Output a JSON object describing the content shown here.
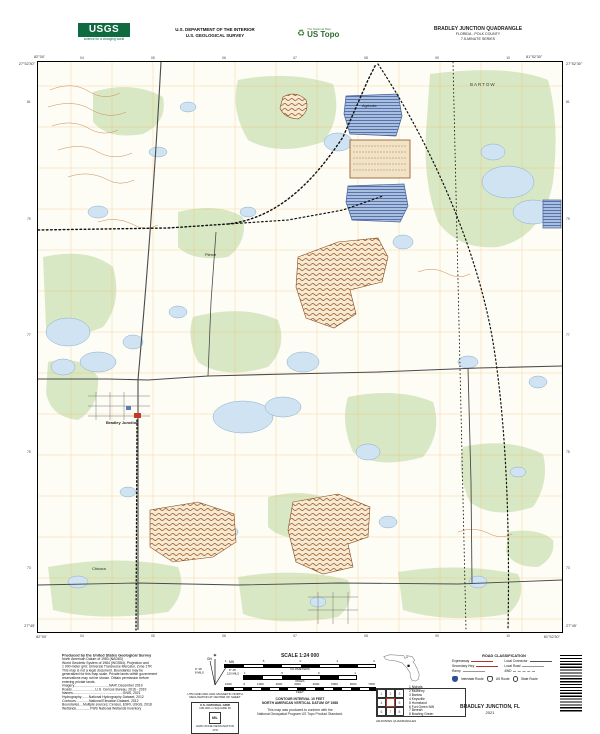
{
  "header": {
    "usgs_logo": "USGS",
    "usgs_tagline": "science for a changing world",
    "dept_line1": "U.S. DEPARTMENT OF THE INTERIOR",
    "dept_line2": "U.S. GEOLOGICAL SURVEY",
    "ustopo_overline": "The National Map",
    "ustopo_brand": "US Topo",
    "quad_title": "BRADLEY JUNCTION QUADRANGLE",
    "quad_subtitle1": "FLORIDA - POLK COUNTY",
    "quad_subtitle2": "7.5-MINUTE SERIES"
  },
  "map": {
    "corner_top_left_lat": "27°52'30\"",
    "corner_top_left_lon": "82°00'",
    "corner_top_right_lat": "27°52'30\"",
    "corner_top_right_lon": "81°52'30\"",
    "corner_bottom_left_lat": "27°45'",
    "corner_bottom_left_lon": "82°00'",
    "corner_bottom_right_lat": "27°45'",
    "corner_bottom_right_lon": "81°52'30\"",
    "ticks_top": [
      "04",
      "05",
      "06",
      "07",
      "08",
      "09",
      "10"
    ],
    "ticks_bottom": [
      "04",
      "05",
      "06",
      "07",
      "08",
      "09",
      "10"
    ],
    "ticks_left": [
      "81",
      "79",
      "77",
      "75",
      "73"
    ],
    "ticks_right": [
      "81",
      "79",
      "77",
      "75",
      "73"
    ],
    "labels": {
      "bartow": "BARTOW",
      "agricola": "Agricola",
      "pierce": "Pierce",
      "bradley_junction": "Bradley Junction",
      "chicora": "Chicora"
    }
  },
  "footer": {
    "produced": {
      "title": "Produced by the United States Geological Survey",
      "lines": [
        "North American Datum of 1983 (NAD83)",
        "World Geodetic System of 1984 (WGS84).  Projection and",
        "1 000-meter grid: Universal Transverse Mercator, Zone 17R",
        "This map is not a legal document. Boundaries may be",
        "generalized for this map scale. Private lands within government",
        "reservations may not be shown. Obtain permission before",
        "entering private lands.",
        "",
        "Imagery.....................................NAIP, December 2019",
        "Roads.........................U.S. Census Bureau, 2016 - 2019",
        "Names.....................................................GNIS, 2021",
        "Hydrography........National Hydrography Dataset, 2012",
        "Contours..............National Elevation Dataset, 2012",
        "Boundaries....Multiple sources; Census, ESRI, USGS, 2018",
        "Wetlands...............FWS National Wetlands Inventory"
      ]
    },
    "declination": {
      "star": "✶",
      "gn": "GN",
      "mn": "MN",
      "gn_value": "0° 26'",
      "gn_mils": "8 MILS",
      "mn_value": "6° 45'",
      "mn_mils": "120 MILS",
      "caption1": "UTM GRID AND 2021 MAGNETIC NORTH",
      "caption2": "DECLINATION AT CENTER OF SHEET"
    },
    "usng": {
      "title": "U.S. NATIONAL GRID",
      "sub": "100,000-m SQUARE ID",
      "square_id": "ML",
      "gzd_label": "GRID ZONE DESIGNATION",
      "gzd": "17R"
    },
    "scale": {
      "title": "SCALE 1:24 000",
      "km_ticks": [
        "1",
        ".5",
        "0",
        "1",
        "2"
      ],
      "km_label": "KILOMETERS",
      "mi_ticks": [
        "1",
        ".5",
        "0",
        "1"
      ],
      "mi_label": "MILES",
      "ft_ticks": [
        "1000",
        "0",
        "1000",
        "2000",
        "3000",
        "4000",
        "5000",
        "6000",
        "7000"
      ],
      "ft_label": "FEET",
      "contour": "CONTOUR INTERVAL 10 FEET",
      "datum": "NORTH AMERICAN VERTICAL DATUM OF 1988",
      "conform1": "This map was produced to conform with the",
      "conform2": "National Geospatial Program US Topo Product Standard."
    },
    "location_caption": "QUADRANGLE LOCATION",
    "adjoining": {
      "caption": "ADJOINING QUADRANGLES",
      "items": [
        {
          "n": "1",
          "name": "Nichols"
        },
        {
          "n": "2",
          "name": "Mulberry"
        },
        {
          "n": "3",
          "name": "Bartow"
        },
        {
          "n": "4",
          "name": "Keysville"
        },
        {
          "n": "5",
          "name": "Homeland"
        },
        {
          "n": "6",
          "name": "Fort Green NW"
        },
        {
          "n": "7",
          "name": "Bereah"
        },
        {
          "n": "8",
          "name": "Bowling Green"
        }
      ]
    },
    "roads": {
      "title": "ROAD CLASSIFICATION",
      "expressway": "Expressway",
      "secondary": "Secondary Hwy",
      "ramp": "Ramp",
      "local_connector": "Local Connector",
      "local_road": "Local Road",
      "fwd": "4WD",
      "interstate": "Interstate Route",
      "us_route": "US Route",
      "state_route": "State Route"
    },
    "imprint": {
      "title": "BRADLEY JUNCTION,  FL",
      "year": "2021"
    }
  },
  "colors": {
    "usgs_green": "#0f6b3f",
    "road_red": "#b5342c",
    "water_fill": "#cfe3f2",
    "vegetation": "#d9e8c4",
    "mine_brown": "#96511d",
    "grid_orange": "#f0a23a"
  }
}
